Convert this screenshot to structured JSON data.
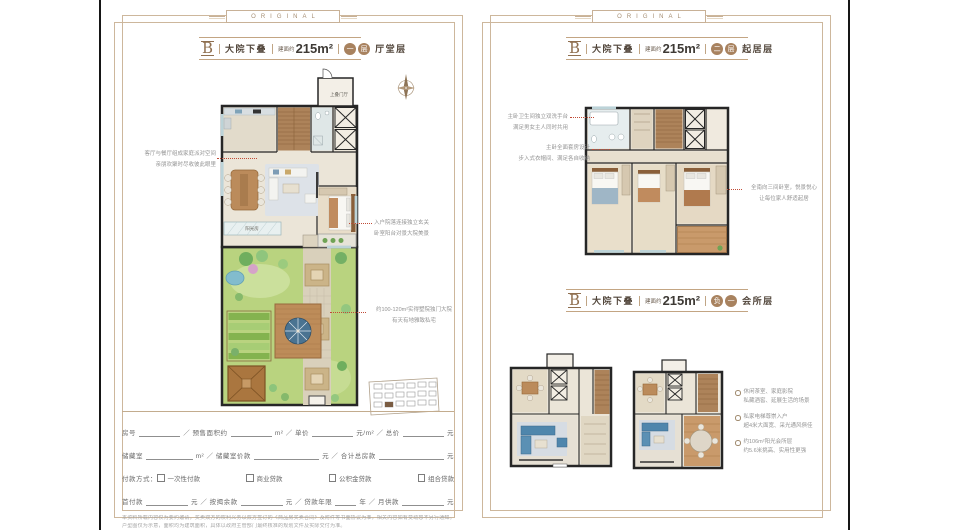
{
  "brand_banner": "ORIGINAL",
  "page_left": {
    "title": {
      "letter": "B",
      "name": "大院下叠",
      "area_prefix": "建面约",
      "area": "215m²",
      "badges": [
        "一",
        "层"
      ],
      "floor": "厅堂层"
    },
    "plan_labels": {
      "upper_lobby": "上叠门厅",
      "sunroom": "阳光房"
    },
    "annotations": [
      {
        "lines": [
          "客厅与餐厅组成家庭派对空间",
          "亲朋欢聚时尽收彼此眼里"
        ]
      },
      {
        "lines": [
          "入户院落连接独立玄关",
          "卧室阳台对景大院美景"
        ]
      },
      {
        "lines": [
          "约100-120m²实得墅院独门大院",
          "有天有地雅致私宅"
        ]
      }
    ],
    "form": {
      "rows": [
        {
          "cells": [
            {
              "t": "房号"
            },
            {
              "b": 1
            },
            {
              "t": "／ 预售面积约"
            },
            {
              "b": 1
            },
            {
              "t": "m² ／ 单价"
            },
            {
              "b": 1
            },
            {
              "t": "元/m² ／ 总价"
            },
            {
              "b": 1
            },
            {
              "t": "元"
            }
          ]
        },
        {
          "cells": [
            {
              "t": "储藏室"
            },
            {
              "b": 1
            },
            {
              "t": "m² ／ 储藏室价款"
            },
            {
              "b": 1.4
            },
            {
              "t": "元 ／ 合计总房款"
            },
            {
              "b": 1.4
            },
            {
              "t": "元"
            }
          ]
        },
        {
          "cells": [
            {
              "t": "付款方式："
            },
            {
              "c": "一次性付款"
            },
            {
              "sp": 1
            },
            {
              "c": "商业贷款"
            },
            {
              "sp": 1
            },
            {
              "c": "公积金贷款"
            },
            {
              "sp": 1
            },
            {
              "c": "组合贷款"
            }
          ]
        },
        {
          "cells": [
            {
              "t": "首付款"
            },
            {
              "b": 1
            },
            {
              "t": "元 ／ 按揭余款"
            },
            {
              "b": 1
            },
            {
              "t": "元 ／ 贷款年限"
            },
            {
              "b": 0.5
            },
            {
              "t": "年 ／ 月供款"
            },
            {
              "b": 1
            },
            {
              "t": "元"
            }
          ]
        }
      ],
      "disclaimer": [
        "本资料所载内容仅为要约邀请，买卖双方的权利义务以双方签订的《商品房买卖合同》及附件等书面协议为准，相关内容如有变动恕不另行通知。",
        "户型图仅为示意，面积均为建筑面积，具体以政府主管部门最终核准的规划文件及实际交付为准。"
      ]
    }
  },
  "page_right": {
    "title_upper": {
      "letter": "B",
      "name": "大院下叠",
      "area_prefix": "建面约",
      "area": "215m²",
      "badges": [
        "二",
        "层"
      ],
      "floor": "起居层"
    },
    "title_lower": {
      "letter": "B",
      "name": "大院下叠",
      "area_prefix": "建面约",
      "area": "215m²",
      "badges": [
        "负",
        "一"
      ],
      "floor": "会所层"
    },
    "annotations": [
      {
        "lines": [
          "主卧卫生间独立双洗手台",
          "满足男女主人同时共用"
        ]
      },
      {
        "lines": [
          "主卧全面套房设计",
          "步入式衣帽间、满足各自收纳"
        ]
      },
      {
        "lines": [
          "全南向三间卧室，悦景悦心",
          "让每位家人舒适起居"
        ]
      }
    ],
    "bullets": [
      {
        "lines": [
          "休闲茶室、家庭影院",
          "私藏酒窖、延展生活的场景"
        ]
      },
      {
        "lines": [
          "私家电梯尊崇入户",
          "超4米大面宽、采光通风俱佳"
        ]
      },
      {
        "lines": [
          "约106m²阳光会所层",
          "约5.6米挑高、实用性更强"
        ]
      }
    ]
  }
}
